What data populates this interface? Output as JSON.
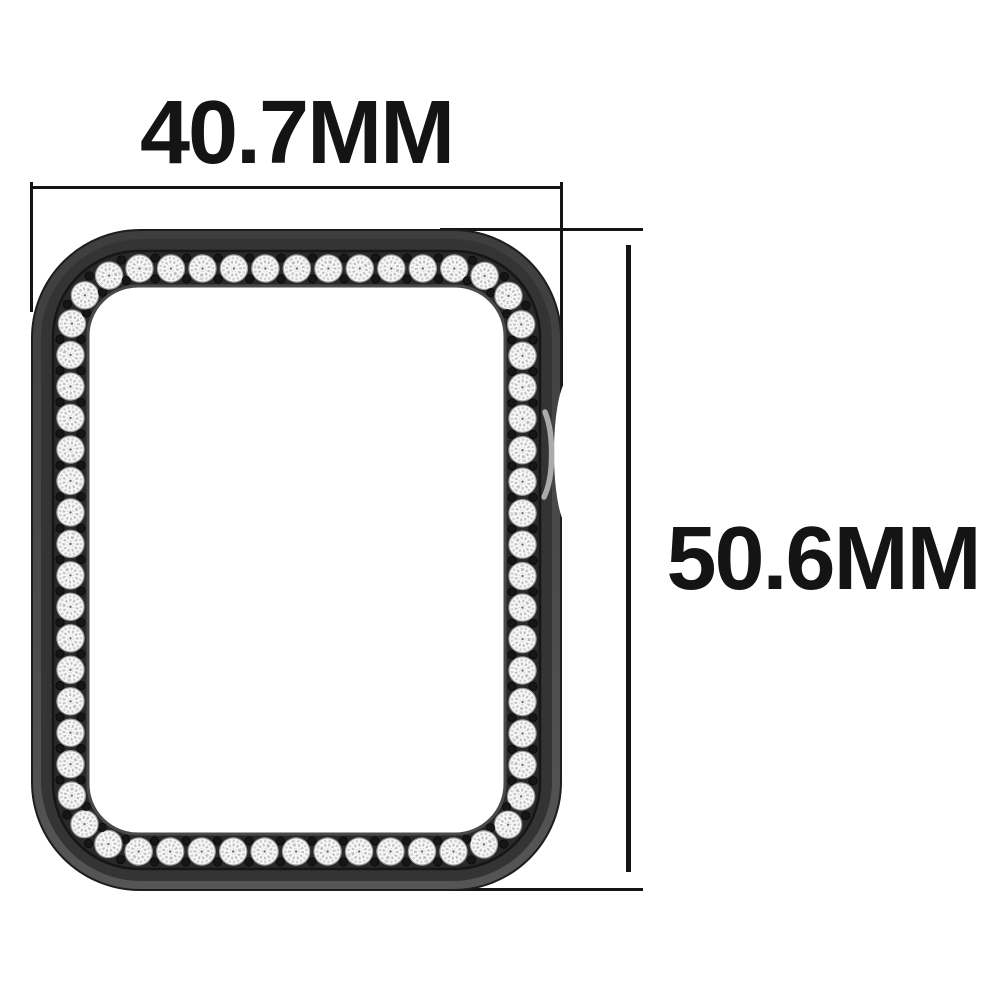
{
  "diagram": {
    "width_label": "40.7MM",
    "height_label": "50.6MM"
  },
  "case": {
    "stone_count": 62,
    "holes_per_gap": 2,
    "colors": {
      "background": "#ffffff",
      "dimension_line": "#141414",
      "label_text": "#141414",
      "shell_top": "#3e3e3e",
      "shell_bottom": "#555555",
      "face": "#343434",
      "bezel_band": "#292929",
      "band_seam": "#161616",
      "inner_lip": "#4a4a4a",
      "opening": "#ffffff",
      "stone": "#f8f8f8",
      "stone_ring": "#9b9b9b",
      "stone_facet_light": "#d2d2d2",
      "stone_facet_mid": "#bfbfbf",
      "stone_facet_fine": "#dcdcdc",
      "stone_center": "#6f6f6f",
      "hole_dot": "#161616",
      "notch_highlight": "#ababab"
    }
  }
}
